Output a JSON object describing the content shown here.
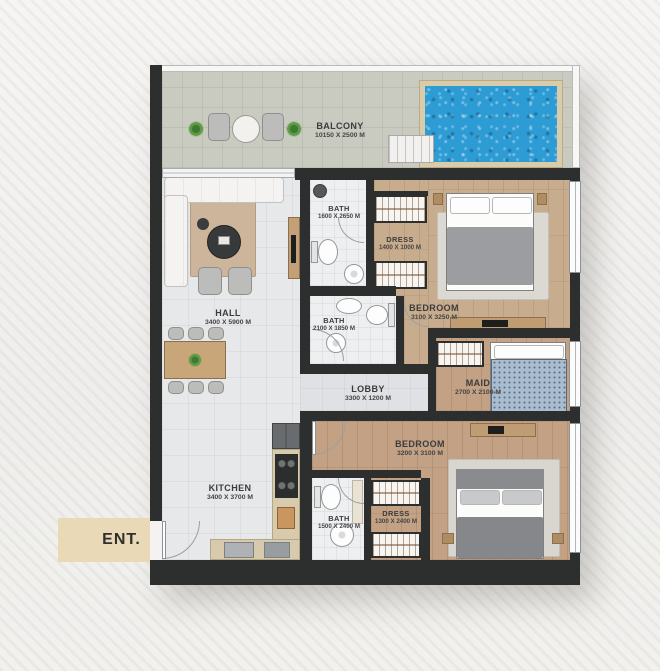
{
  "title": "Apartment Floor Plan",
  "entrance": {
    "label": "ENT."
  },
  "rooms": {
    "balcony": {
      "name": "BALCONY",
      "dims": "10150 X 2500 M"
    },
    "hall": {
      "name": "HALL",
      "dims": "3400 X 5900 M"
    },
    "kitchen": {
      "name": "KITCHEN",
      "dims": "3400 X 3700 M"
    },
    "bath1": {
      "name": "BATH",
      "dims": "1600 X 2650 M"
    },
    "dress1": {
      "name": "DRESS",
      "dims": "1400 X 1000 M"
    },
    "bedroom1": {
      "name": "BEDROOM",
      "dims": "3100 X 3250 M"
    },
    "bath2": {
      "name": "BATH",
      "dims": "2100 X 1850 M"
    },
    "lobby": {
      "name": "LOBBY",
      "dims": "3300 X 1200 M"
    },
    "maid": {
      "name": "MAID",
      "dims": "2700 X 2100 M"
    },
    "bedroom2": {
      "name": "BEDROOM",
      "dims": "3200 X 3100 M"
    },
    "bath3": {
      "name": "BATH",
      "dims": "1500 X 2400 M"
    },
    "dress2": {
      "name": "DRESS",
      "dims": "1300 X 2400 M"
    }
  },
  "colors": {
    "wall": "#2d2f2e",
    "pool_water": "#2e9cd4",
    "wood_floor": "#c8ac8e",
    "tile_floor": "#e7e8ea",
    "balcony_floor": "#c9cbc0",
    "entrance_bg": "#ead9b6",
    "pool_deck": "#dbcca9"
  }
}
